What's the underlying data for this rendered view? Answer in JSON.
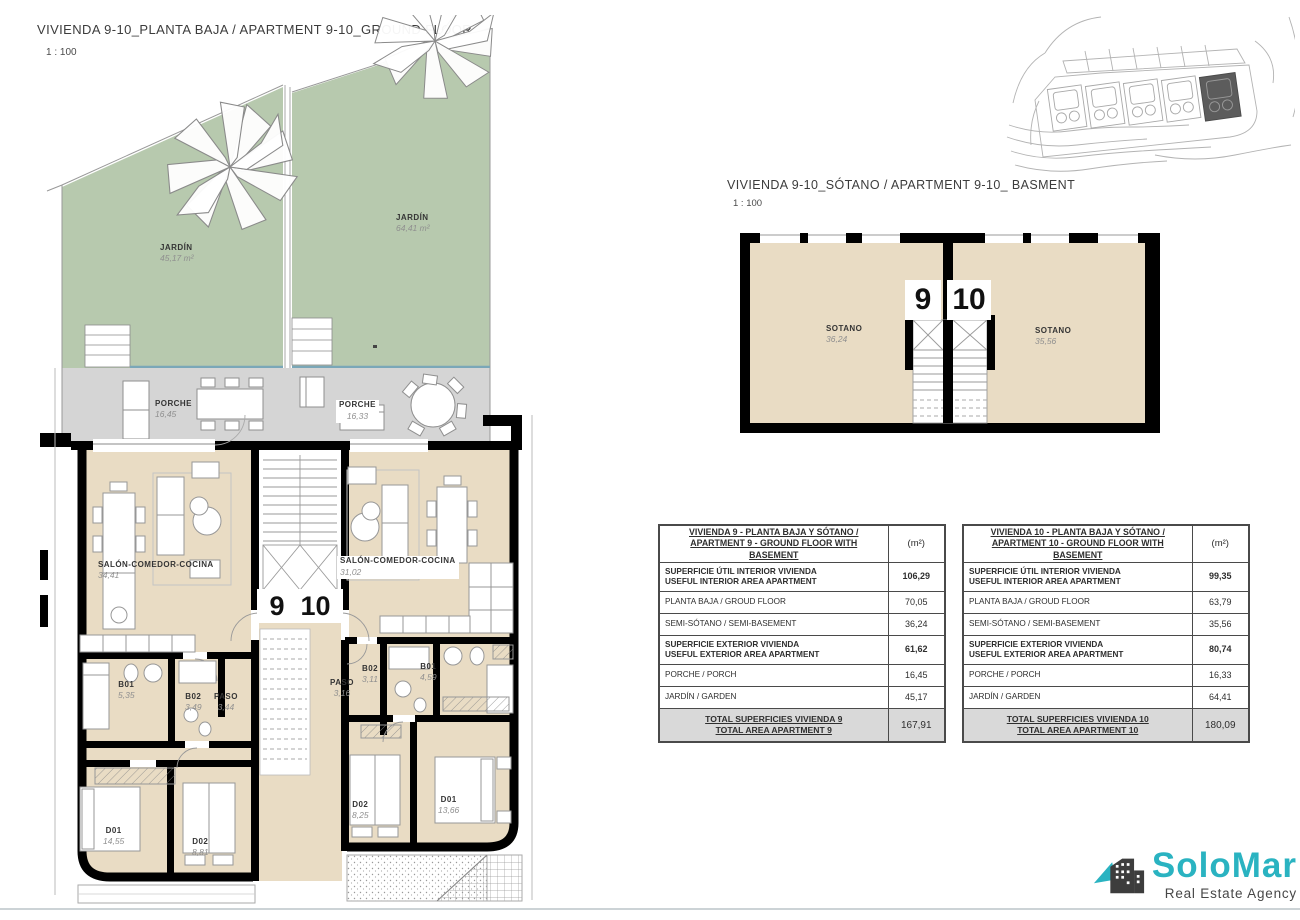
{
  "ground_floor": {
    "title": "VIVIENDA 9-10_PLANTA BAJA / APARTMENT 9-10_GROUND FLOOR",
    "scale": "1 : 100",
    "unit_left_number": "9",
    "unit_right_number": "10",
    "labels": {
      "jardin_left": {
        "name": "JARDÍN",
        "area": "45,17 m²"
      },
      "jardin_right": {
        "name": "JARDÍN",
        "area": "64,41 m²"
      },
      "porche_left": {
        "name": "PORCHE",
        "area": "16,45"
      },
      "porche_right": {
        "name": "PORCHE",
        "area": "16,33"
      },
      "salon_left": {
        "name": "SALÓN-COMEDOR-COCINA",
        "area": "34,41"
      },
      "salon_right": {
        "name": "SALÓN-COMEDOR-COCINA",
        "area": "31,02"
      },
      "b01_left": {
        "name": "B01",
        "area": "5,35"
      },
      "b02_left": {
        "name": "B02",
        "area": "3,49"
      },
      "paso_left": {
        "name": "PASO",
        "area": "3,44"
      },
      "d01_left": {
        "name": "D01",
        "area": "14,55"
      },
      "d02_left": {
        "name": "D02",
        "area": "8,81"
      },
      "paso_right": {
        "name": "PASO",
        "area": "3,16"
      },
      "b02_right": {
        "name": "B02",
        "area": "3,11"
      },
      "b01_right": {
        "name": "B01",
        "area": "4,59"
      },
      "d02_right": {
        "name": "D02",
        "area": "8,25"
      },
      "d01_right": {
        "name": "D01",
        "area": "13,66"
      }
    }
  },
  "basement": {
    "title": "VIVIENDA 9-10_SÓTANO  / APARTMENT 9-10_ BASMENT",
    "scale": "1 : 100",
    "unit_left_number": "9",
    "unit_right_number": "10",
    "labels": {
      "sotano_left": {
        "name": "SOTANO",
        "area": "36,24"
      },
      "sotano_right": {
        "name": "SOTANO",
        "area": "35,56"
      }
    }
  },
  "area_tables": [
    {
      "header": {
        "title_line1": "VIVIENDA 9 - PLANTA BAJA Y SÓTANO /",
        "title_line2": "APARTMENT 9 - GROUND FLOOR WITH BASEMENT",
        "unit": "(m²)"
      },
      "rows": [
        {
          "line1": "SUPERFICIE ÚTIL INTERIOR VIVIENDA",
          "line2": "USEFUL INTERIOR AREA APARTMENT",
          "value": "106,29"
        },
        {
          "line1": "PLANTA BAJA / GROUD FLOOR",
          "value": "70,05"
        },
        {
          "line1": "SEMI-SÓTANO / SEMI-BASEMENT",
          "value": "36,24"
        },
        {
          "line1": "SUPERFICIE EXTERIOR VIVIENDA",
          "line2": "USEFUL EXTERIOR AREA APARTMENT",
          "value": "61,62"
        },
        {
          "line1": "PORCHE / PORCH",
          "value": "16,45"
        },
        {
          "line1": "JARDÍN / GARDEN",
          "value": "45,17"
        }
      ],
      "total": {
        "line1": "TOTAL SUPERFICIES VIVIENDA 9",
        "line2": "TOTAL AREA APARTMENT 9",
        "value": "167,91"
      }
    },
    {
      "header": {
        "title_line1": "VIVIENDA 10 - PLANTA BAJA Y SÓTANO /",
        "title_line2": "APARTMENT 10 - GROUND FLOOR WITH BASEMENT",
        "unit": "(m²)"
      },
      "rows": [
        {
          "line1": "SUPERFICIE ÚTIL INTERIOR VIVIENDA",
          "line2": "USEFUL INTERIOR AREA APARTMENT",
          "value": "99,35"
        },
        {
          "line1": "PLANTA BAJA / GROUD FLOOR",
          "value": "63,79"
        },
        {
          "line1": "SEMI-SÓTANO / SEMI-BASEMENT",
          "value": "35,56"
        },
        {
          "line1": "SUPERFICIE EXTERIOR VIVIENDA",
          "line2": "USEFUL EXTERIOR AREA APARTMENT",
          "value": "80,74"
        },
        {
          "line1": "PORCHE / PORCH",
          "value": "16,33"
        },
        {
          "line1": "JARDÍN / GARDEN",
          "value": "64,41"
        }
      ],
      "total": {
        "line1": "TOTAL SUPERFICIES VIVIENDA 10",
        "line2": "TOTAL AREA APARTMENT 10",
        "value": "180,09"
      }
    }
  ],
  "logo": {
    "brand": "SoloMar",
    "tagline": "Real Estate Agency"
  },
  "colors": {
    "garden": "#b7c9ae",
    "porch": "#d5d5d5",
    "interior": "#e9dcc4",
    "wall": "#000000",
    "pool_edge": "#7aa7b8",
    "table_grey": "#d9d9d9",
    "brand_teal": "#2ab3c1",
    "brand_dark": "#474747"
  }
}
